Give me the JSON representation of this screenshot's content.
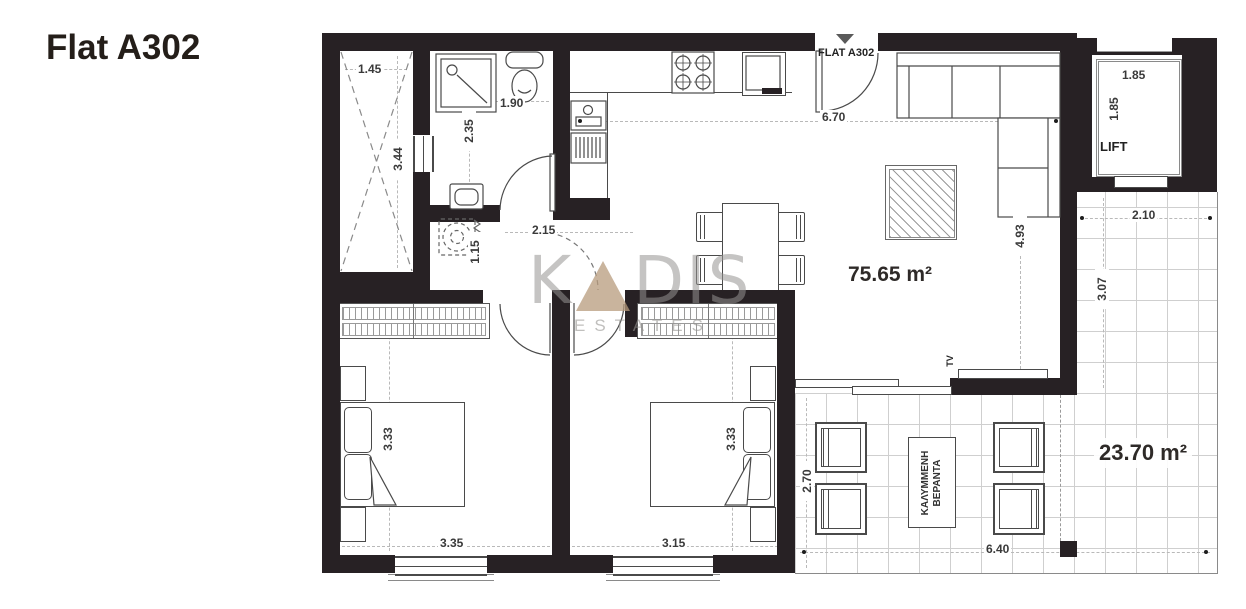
{
  "title": "Flat A302",
  "plan": {
    "entrance_label": "FLAT A302",
    "lift_label": "LIFT",
    "living_area": "75.65 m²",
    "terrace_area": "23.70 m²",
    "veranda_label_line1": "ΚΑΛΥΜΜΕΝΗ",
    "veranda_label_line2": "ΒΕΡΑΝΤΑ",
    "tv_label": "TV"
  },
  "dimensions": {
    "light_well_width": "1.45",
    "light_well_height": "3.44",
    "bathroom_width": "1.90",
    "bathroom_height": "2.35",
    "hallway_width": "2.15",
    "laundry_height": "1.15",
    "living_width": "6.70",
    "living_height": "4.93",
    "lift_width": "1.85",
    "lift_height": "1.85",
    "terrace_side_width": "2.10",
    "terrace_side_height": "3.07",
    "bedroom1_height": "3.33",
    "bedroom1_width": "3.35",
    "bedroom2_height": "3.33",
    "bedroom2_width": "3.15",
    "terrace_height": "2.70",
    "terrace_width": "6.40"
  },
  "watermark": {
    "k": "K",
    "a": "A",
    "dis": "DIS",
    "sub": "ESTATES"
  },
  "colors": {
    "wall": "#272124",
    "line": "#4a4a4a",
    "grid": "#cfcfcf",
    "watermark_gray": "#a9a7a4",
    "watermark_tan": "#b79b7c"
  }
}
